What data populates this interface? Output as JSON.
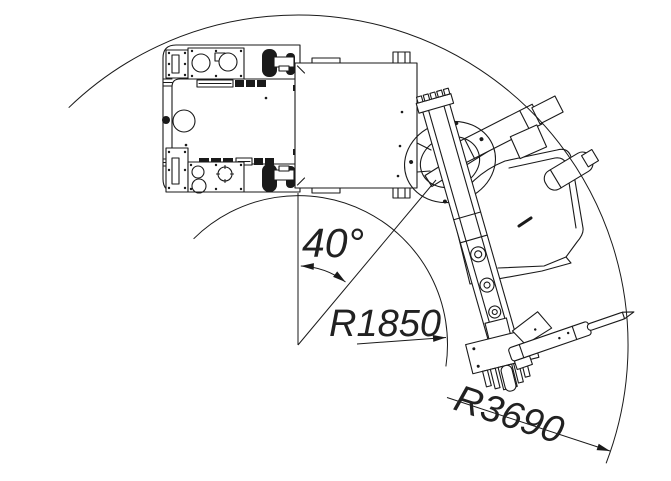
{
  "drawing": {
    "background": "#ffffff",
    "line_color": "#1a1a1a",
    "annotations": {
      "swing_angle": {
        "label": "40°",
        "value_deg": 40
      },
      "inner_radius": {
        "label": "R1850",
        "value_mm": 1850
      },
      "outer_radius": {
        "label": "R3690",
        "value_mm": 3690
      }
    }
  }
}
